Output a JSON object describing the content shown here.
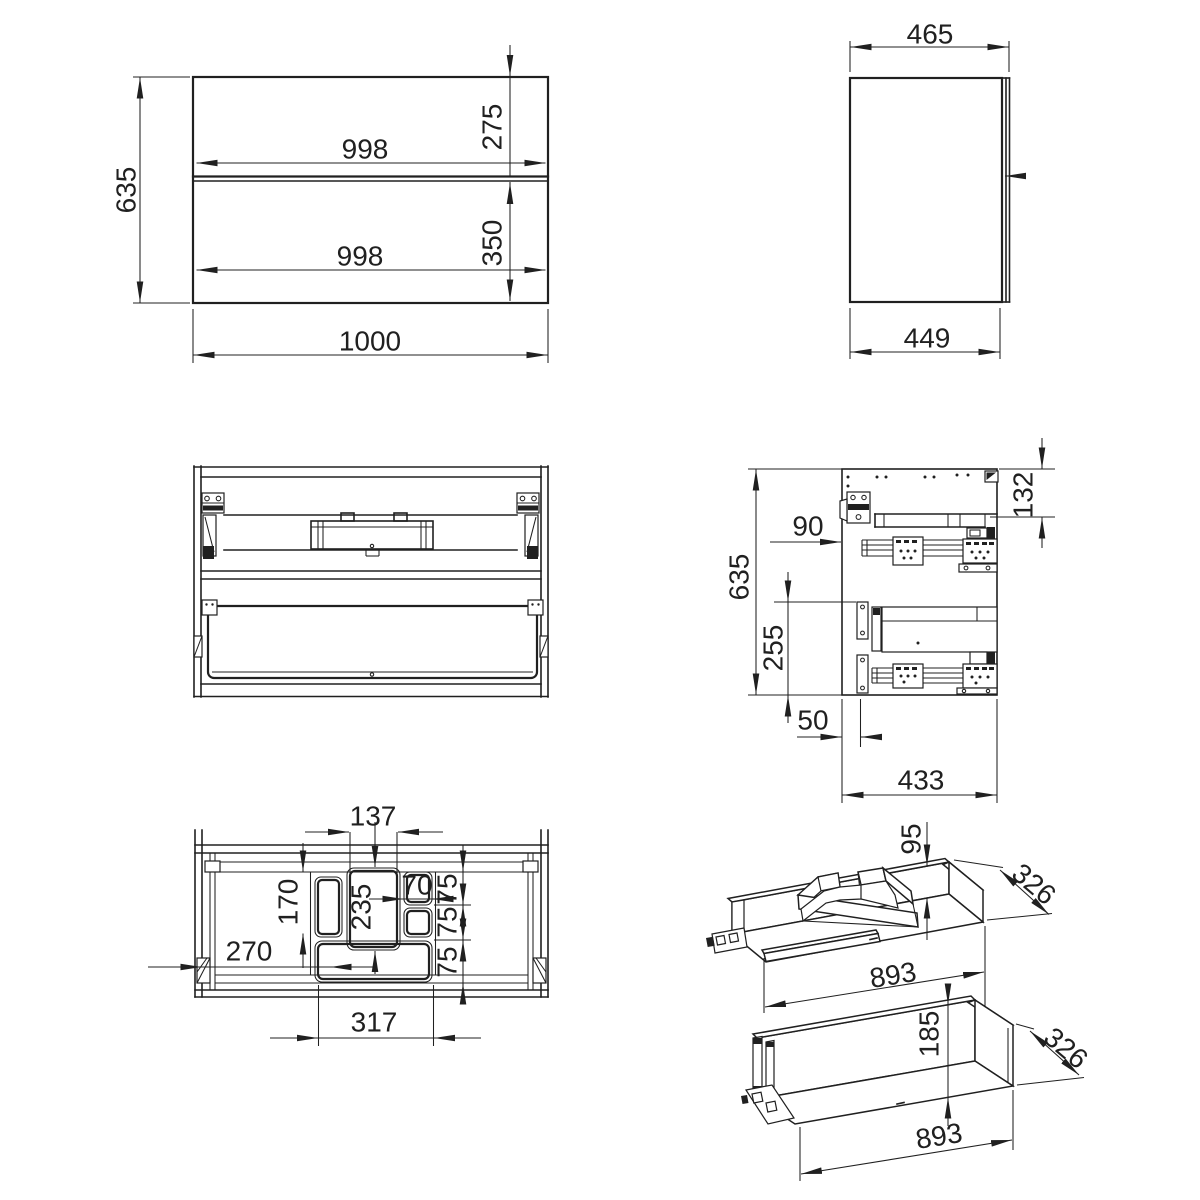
{
  "drawing": {
    "views": {
      "front": {
        "height": "635",
        "upper_front_width": "998",
        "upper_front_height": "275",
        "lower_front_width": "998",
        "lower_front_height": "350",
        "overall_width": "1000"
      },
      "side": {
        "overall_depth": "465",
        "carcass_depth": "449"
      },
      "section": {
        "top_offset": "132",
        "slide_setback": "90",
        "height": "635",
        "lower_span": "255",
        "front_inset": "50",
        "depth": "433"
      },
      "plan": {
        "center_cutout_width": "137",
        "left_cutout_length": "170",
        "center_cutout_length": "235",
        "small_cutout_width": "70",
        "small_cutout_heights": [
          "75",
          "75",
          "75"
        ],
        "left_offset": "270",
        "tray_span": "317"
      },
      "upper_drawer": {
        "wall_height": "95",
        "depth": "326",
        "width": "893"
      },
      "lower_drawer": {
        "height": "185",
        "depth": "326",
        "width": "893"
      }
    }
  }
}
